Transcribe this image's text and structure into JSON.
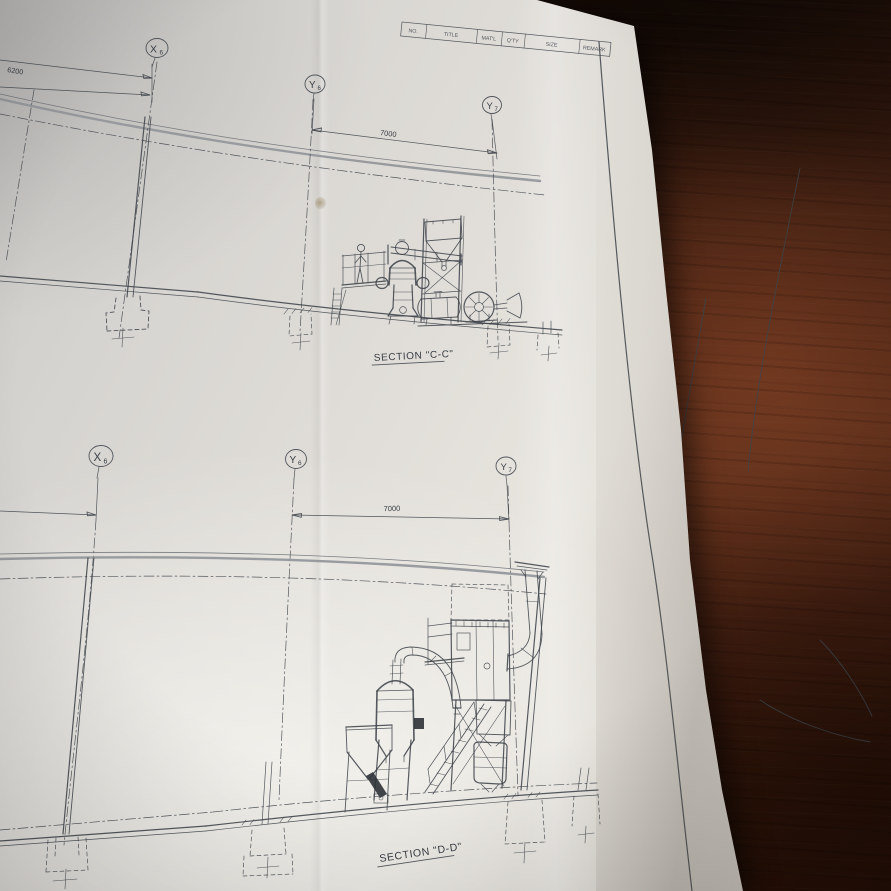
{
  "meta": {
    "description": "Photo of a folded engineering drawing on a dark wooden table",
    "paper_color": "#e4e1db",
    "wood_color": "#4a2414",
    "line_color": "#3f444b"
  },
  "title_block": {
    "fields": [
      "NO.",
      "TITLE",
      "MAT'L",
      "Q'TY",
      "SIZE",
      "REMARK"
    ]
  },
  "sections": {
    "upper": {
      "label": "SECTION \"C-C\"",
      "grid": [
        {
          "main": "X",
          "sub": "6"
        },
        {
          "main": "Y",
          "sub": "6"
        },
        {
          "main": "Y",
          "sub": "7"
        }
      ],
      "dims": [
        "6200",
        "7000"
      ]
    },
    "lower": {
      "label": "SECTION \"D-D\"",
      "grid": [
        {
          "main": "X",
          "sub": "6"
        },
        {
          "main": "Y",
          "sub": "6"
        },
        {
          "main": "Y",
          "sub": "7"
        }
      ],
      "dims": [
        "7000"
      ]
    }
  }
}
